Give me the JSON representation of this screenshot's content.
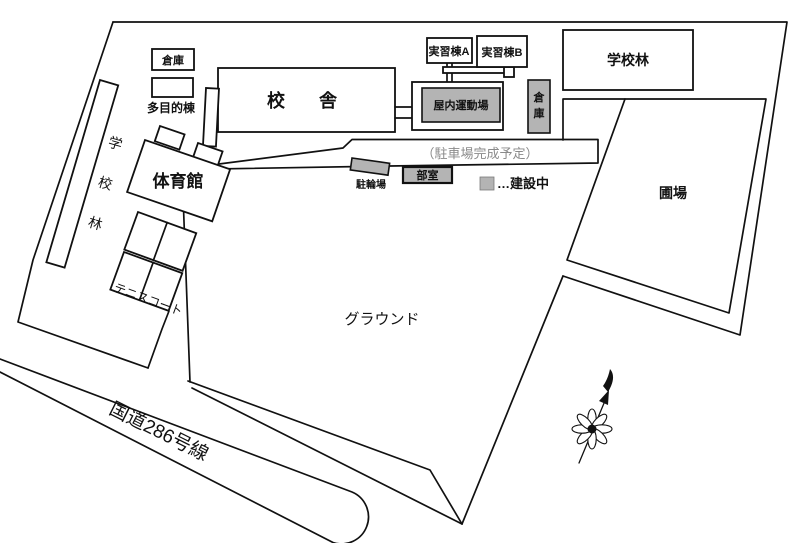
{
  "map": {
    "labels": {
      "storage_left": "倉庫",
      "multipurpose": "多目的棟",
      "school_building": "校　舎",
      "training_a": "実習棟A",
      "training_b": "実習棟B",
      "indoor_gym": "屋内運動場",
      "storage_right_1": "倉",
      "storage_right_2": "庫",
      "school_forest_right": "学校林",
      "gymnasium": "体育館",
      "field": "圃場",
      "ground": "グラウンド",
      "tennis_court": "テニスコート",
      "bicycle_parking": "駐輪場",
      "club_room": "部室",
      "parking_planned": "（駐車場完成予定）",
      "road": "国道286号線",
      "forest_char_1": "学",
      "forest_char_2": "校",
      "forest_char_3": "林"
    },
    "legend": {
      "label": "…建設中"
    },
    "colors": {
      "line": "#111111",
      "gray_fill": "#b4b4b4",
      "muted_text": "#8a8a8a",
      "background": "#ffffff"
    }
  }
}
